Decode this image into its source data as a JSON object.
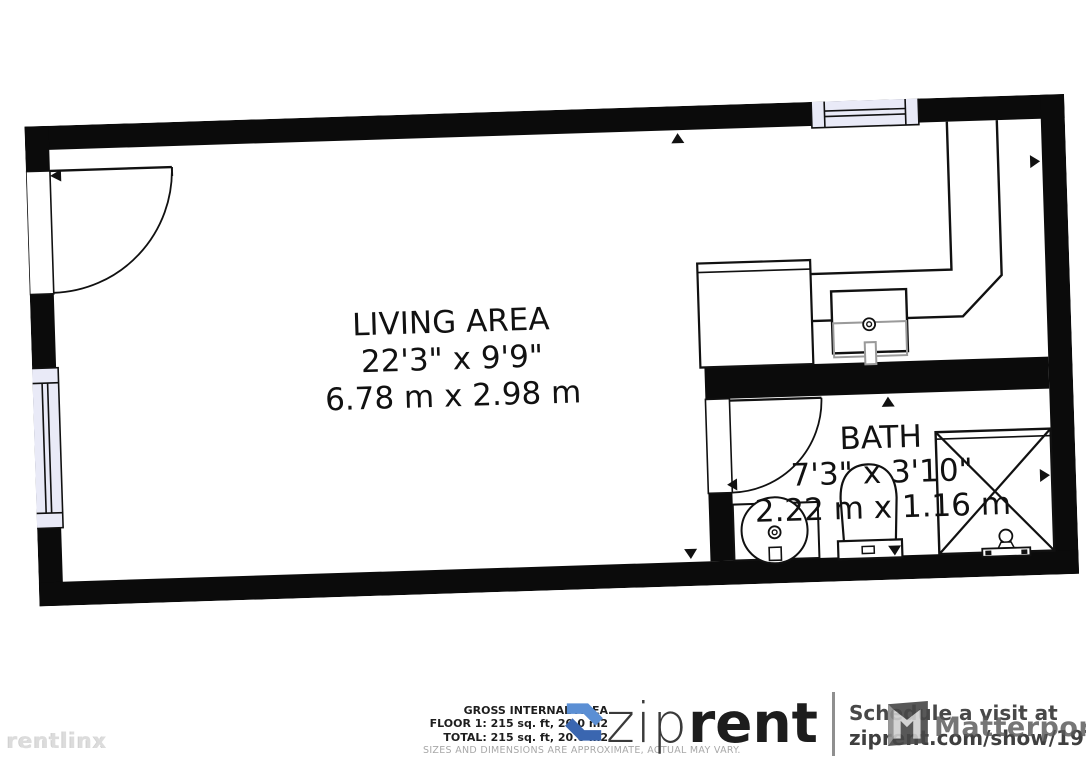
{
  "floor_plan": {
    "rooms": [
      {
        "name": "LIVING AREA",
        "dims_imperial": "22'3\" x 9'9\"",
        "dims_metric": "6.78 m x 2.98 m"
      },
      {
        "name": "BATH",
        "dims_imperial": "7'3\" x 3'10\"",
        "dims_metric": "2.22 m x 1.16 m"
      }
    ]
  },
  "footer": {
    "area_summary": {
      "gross": "GROSS INTERNAL AREA",
      "floor1": "FLOOR 1: 215 sq. ft, 20.0 m2",
      "total": "TOTAL: 215 sq. ft, 20.0 m2",
      "disclaimer": "SIZES AND DIMENSIONS ARE APPROXIMATE, ACTUAL MAY VARY."
    },
    "brand": {
      "zip": "zip",
      "rent": "rent"
    },
    "cta": {
      "line1": "Schedule a visit at",
      "line2": "ziprent.com/show/19722"
    },
    "watermarks": {
      "matterport": "Matterport",
      "rentlinx": "rentlinx"
    }
  },
  "colors": {
    "wall": "#0b0b0b",
    "window_fill": "#e9eaf7",
    "brand_blue_light": "#5b8fd4",
    "brand_blue_dark": "#3a66b0",
    "footer_text": "#1e1e1e",
    "footer_gray": "#a8a8a8"
  }
}
